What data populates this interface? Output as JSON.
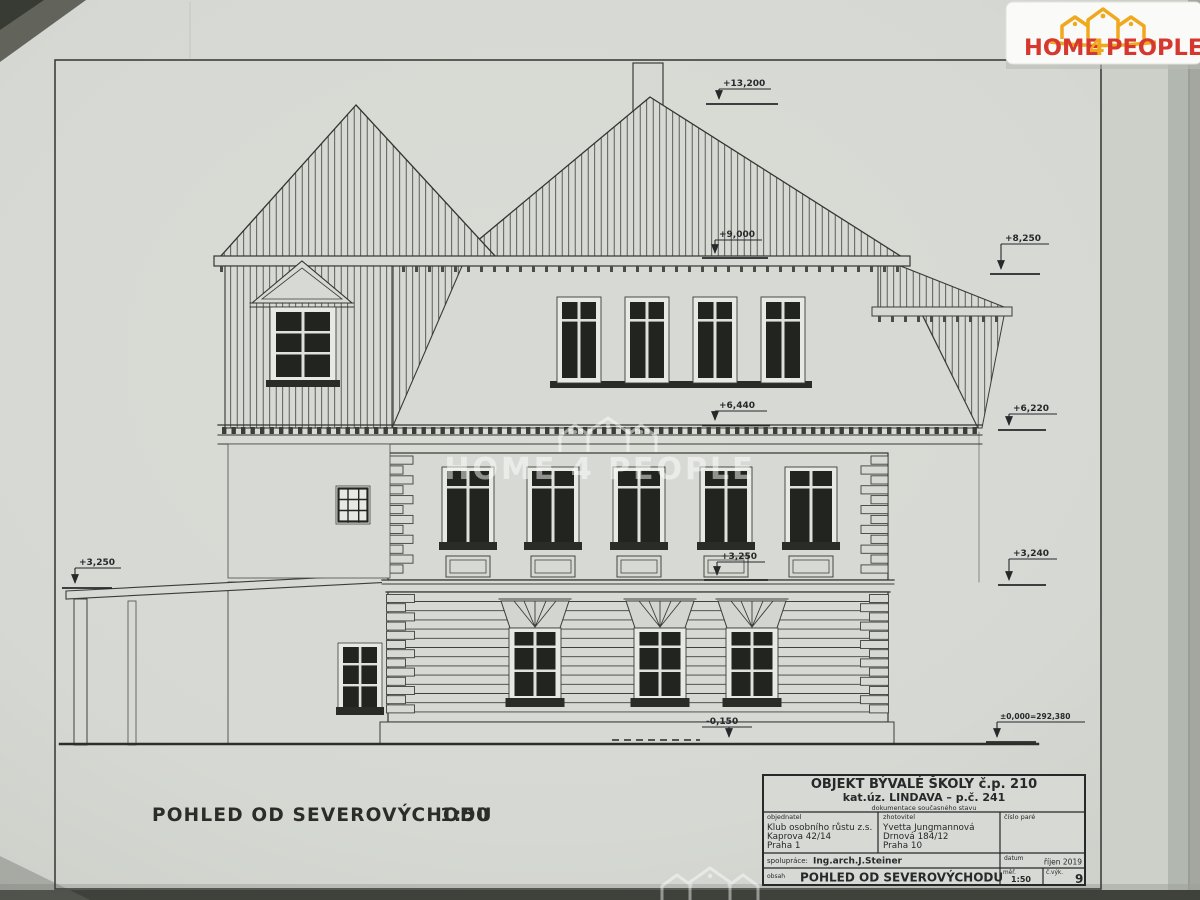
{
  "sheet": {
    "caption": "POHLED OD SEVEROVÝCHODU",
    "caption_scale": "1:50"
  },
  "logo": {
    "home": "HOME",
    "four": "4",
    "people": "PEOPLE"
  },
  "watermark": {
    "text": "HOME 4 PEOPLE"
  },
  "markers": {
    "ridge": "+13,200",
    "main_eave": "+9,000",
    "right_eave": "+8,250",
    "attic_cornice": "+6,440",
    "right_cornice": "+6,220",
    "floor_center": "+3,250",
    "porch": "+3,250",
    "right_floor": "+3,240",
    "base_center": "-0,150",
    "base_right": "±0,000=292,380"
  },
  "title_block": {
    "project_line1": "OBJEKT BÝVALÉ ŠKOLY č.p. 210",
    "project_line2": "kat.úz. LINDAVA – p.č. 241",
    "project_line3": "dokumentace současného stavu",
    "client_label": "objednatel",
    "client_name": "Klub osobního růstu z.s.",
    "client_addr1": "Kaprova 42/14",
    "client_addr2": "Praha 1",
    "author_label": "zhotovitel",
    "author_name": "Yvetta Jungmannová",
    "author_addr1": "Drnová 184/12",
    "author_addr2": "Praha 10",
    "copy_label": "číslo paré",
    "collab_label": "spolupráce:",
    "collab_value": "Ing.arch.J.Steiner",
    "date_label": "datum",
    "date_value": "říjen 2019",
    "content_label": "obsah",
    "content_value": "POHLED OD SEVEROVÝCHODU",
    "scale_label": "měř.",
    "scale_value": "1:50",
    "sheet_no_label": "č.výk.",
    "sheet_no_value": "9"
  },
  "colors": {
    "logo_red": "#d6372e",
    "logo_yellow": "#f0a81c",
    "paper": "#d6d9d3",
    "ink": "#32352f"
  }
}
